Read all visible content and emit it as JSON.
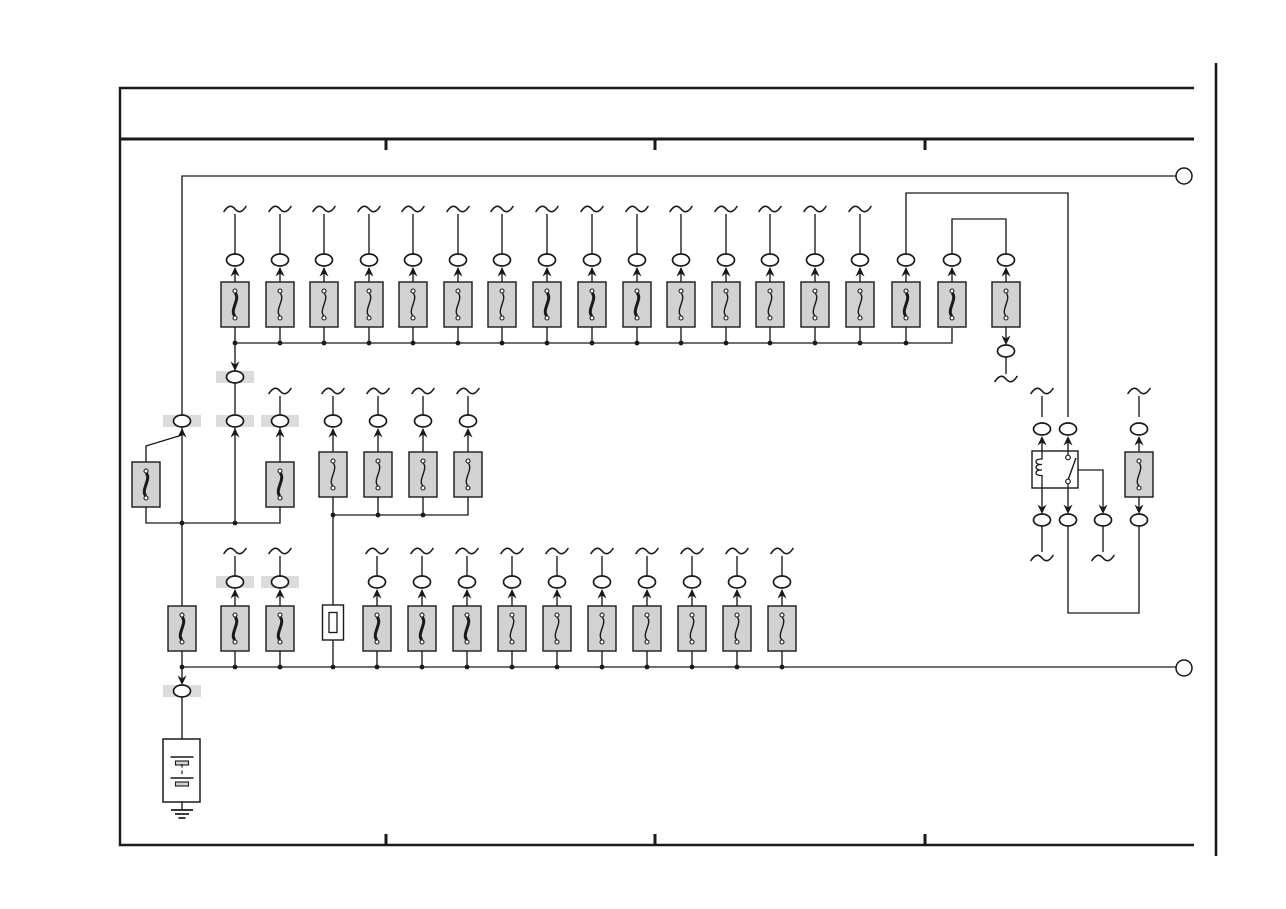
{
  "meta": {
    "page_type": "vehicle wiring schematic - power source / fuse block page",
    "width": 1286,
    "height": 909
  },
  "colors": {
    "line": "#1a1a1a",
    "fuse_fill": "#d2d2d2",
    "band_fill": "#dcdcdc",
    "component_fill": "#ffffff",
    "background": "#ffffff"
  },
  "style": {
    "wire_width": 1.35,
    "oval_rx": 8.5,
    "oval_ry": 6,
    "band_w": 38,
    "band_h": 12,
    "dot_r": 2.4,
    "ring_r": 8,
    "fuse_w": 28,
    "fuse_h": 45
  },
  "frame": {
    "border": {
      "left_x": 120,
      "top_y": 88,
      "right_x": 1194,
      "bottom_y": 845,
      "stroke_w": 2.4
    },
    "separator": {
      "y": 139,
      "x1": 120,
      "x2": 1194,
      "stroke_w": 3
    },
    "tick_xs": [
      386,
      655,
      925
    ],
    "tick_len": 10,
    "tick_stroke_w": 3,
    "page_edge": {
      "x": 1216,
      "y1": 63,
      "y2": 856,
      "stroke_w": 2.6
    }
  },
  "connector_rings": [
    [
      1184,
      176
    ],
    [
      1184,
      668
    ]
  ],
  "diagram": {
    "top_row": {
      "fuse_top_y": 282,
      "oval_cy": 260,
      "tilde_cy": 209,
      "bus_y": 343,
      "bus_dot_max_x": 950,
      "cols": [
        [
          235,
          1,
          1
        ],
        [
          280,
          0,
          1
        ],
        [
          324,
          0,
          1
        ],
        [
          369,
          0,
          1
        ],
        [
          413,
          0,
          1
        ],
        [
          458,
          0,
          1
        ],
        [
          502,
          0,
          1
        ],
        [
          547,
          1,
          1
        ],
        [
          592,
          1,
          1
        ],
        [
          637,
          1,
          1
        ],
        [
          681,
          0,
          1
        ],
        [
          726,
          0,
          1
        ],
        [
          770,
          0,
          1
        ],
        [
          815,
          0,
          1
        ],
        [
          860,
          0,
          1
        ],
        [
          906,
          1,
          0
        ],
        [
          952,
          1,
          0
        ],
        [
          1006,
          0,
          0
        ]
      ]
    },
    "mid_group": {
      "fuse_top_y": 452,
      "oval_cy": 421,
      "tilde_cy": 391,
      "bus_y": 515,
      "xs": [
        333,
        378,
        423,
        468
      ]
    },
    "bottom_row": {
      "fuse_top_y": 606,
      "oval_cy": 582,
      "tilde_cy": 551,
      "bus_y": 667,
      "cols": [
        [
          182,
          1,
          0
        ],
        [
          235,
          1,
          1
        ],
        [
          280,
          1,
          1
        ],
        [
          377,
          1,
          2
        ],
        [
          422,
          1,
          2
        ],
        [
          467,
          1,
          2
        ],
        [
          512,
          0,
          2
        ],
        [
          557,
          0,
          2
        ],
        [
          602,
          0,
          2
        ],
        [
          647,
          0,
          2
        ],
        [
          692,
          0,
          2
        ],
        [
          737,
          0,
          2
        ],
        [
          782,
          0,
          2
        ]
      ]
    },
    "extra_fuses": [
      [
        146,
        462,
        1
      ],
      [
        280,
        462,
        1
      ],
      [
        1139,
        452,
        0
      ]
    ],
    "extra_ovals": [
      [
        235,
        377,
        1
      ],
      [
        182,
        421,
        1
      ],
      [
        235,
        421,
        1
      ],
      [
        280,
        421,
        1
      ],
      [
        1006,
        351,
        0
      ],
      [
        1042,
        429,
        0
      ],
      [
        1068,
        429,
        0
      ],
      [
        1139,
        429,
        0
      ],
      [
        1042,
        520,
        0
      ],
      [
        1068,
        520,
        0
      ],
      [
        1103,
        520,
        0
      ],
      [
        1139,
        520,
        0
      ],
      [
        182,
        691,
        1
      ]
    ],
    "extra_arrows": [
      [
        235,
        371,
        -1
      ],
      [
        182,
        428,
        1
      ],
      [
        235,
        428,
        1
      ],
      [
        280,
        428,
        1
      ],
      [
        1006,
        345,
        -1
      ],
      [
        1042,
        436,
        1
      ],
      [
        1068,
        436,
        1
      ],
      [
        1139,
        436,
        1
      ],
      [
        1042,
        514,
        -1
      ],
      [
        1068,
        514,
        -1
      ],
      [
        1103,
        514,
        -1
      ],
      [
        1139,
        514,
        -1
      ],
      [
        182,
        685,
        -1
      ]
    ],
    "extra_tildes": [
      [
        280,
        391
      ],
      [
        1006,
        379
      ],
      [
        1042,
        391
      ],
      [
        1139,
        391
      ],
      [
        1042,
        558
      ],
      [
        1103,
        558
      ]
    ],
    "extra_dots": [
      [
        182,
        523
      ],
      [
        235,
        523
      ],
      [
        333,
        667
      ]
    ],
    "extra_wires": [
      [
        [
          182,
          606
        ],
        [
          182,
          176
        ],
        [
          1176,
          176
        ]
      ],
      [
        [
          235,
          370
        ],
        [
          235,
          343
        ],
        [
          952,
          343
        ],
        [
          952,
          328
        ]
      ],
      [
        [
          906,
          254
        ],
        [
          906,
          193
        ],
        [
          1068,
          193
        ],
        [
          1068,
          417
        ]
      ],
      [
        [
          952,
          254
        ],
        [
          952,
          219
        ],
        [
          1006,
          219
        ],
        [
          1006,
          254
        ]
      ],
      [
        [
          1006,
          327
        ],
        [
          1006,
          344
        ]
      ],
      [
        [
          1006,
          357
        ],
        [
          1006,
          374
        ]
      ],
      [
        [
          235,
          383
        ],
        [
          235,
          414
        ]
      ],
      [
        [
          235,
          428
        ],
        [
          235,
          523
        ]
      ],
      [
        [
          182,
          435
        ],
        [
          146,
          446
        ],
        [
          146,
          462
        ]
      ],
      [
        [
          146,
          507
        ],
        [
          146,
          523
        ],
        [
          280,
          523
        ],
        [
          280,
          507
        ]
      ],
      [
        [
          280,
          462
        ],
        [
          280,
          428
        ]
      ],
      [
        [
          280,
          414
        ],
        [
          280,
          396
        ]
      ],
      [
        [
          333,
          515
        ],
        [
          468,
          515
        ],
        [
          468,
          497
        ]
      ],
      [
        [
          333,
          515
        ],
        [
          333,
          605
        ]
      ],
      [
        [
          1042,
          396
        ],
        [
          1042,
          417
        ]
      ],
      [
        [
          1042,
          451
        ],
        [
          1042,
          438
        ]
      ],
      [
        [
          1042,
          488
        ],
        [
          1042,
          508
        ]
      ],
      [
        [
          1042,
          526
        ],
        [
          1042,
          552
        ]
      ],
      [
        [
          1068,
          451
        ],
        [
          1068,
          438
        ]
      ],
      [
        [
          1068,
          488
        ],
        [
          1068,
          508
        ]
      ],
      [
        [
          1068,
          526
        ],
        [
          1068,
          613
        ],
        [
          1139,
          613
        ],
        [
          1139,
          526
        ]
      ],
      [
        [
          1072,
          470
        ],
        [
          1103,
          470
        ],
        [
          1103,
          508
        ]
      ],
      [
        [
          1103,
          526
        ],
        [
          1103,
          552
        ]
      ],
      [
        [
          1139,
          396
        ],
        [
          1139,
          417
        ]
      ],
      [
        [
          1139,
          452
        ],
        [
          1139,
          438
        ]
      ],
      [
        [
          1139,
          497
        ],
        [
          1139,
          508
        ]
      ],
      [
        [
          333,
          640
        ],
        [
          333,
          667
        ]
      ],
      [
        [
          182,
          667
        ],
        [
          1176,
          667
        ]
      ],
      [
        [
          182,
          667
        ],
        [
          182,
          679
        ]
      ],
      [
        [
          182,
          697
        ],
        [
          182,
          739
        ]
      ],
      [
        [
          182,
          739
        ],
        [
          182,
          757
        ]
      ],
      [
        [
          182,
          785
        ],
        [
          182,
          810
        ]
      ]
    ],
    "fusible_link": {
      "x": 333,
      "top_y": 605,
      "w": 21,
      "h": 35,
      "inner_w": 8,
      "inner_h": 20
    },
    "relay": {
      "x": 1032,
      "y": 451,
      "w": 46,
      "h": 37,
      "coil_x": 1042,
      "switch_x": 1068,
      "contact_top_y": 457.5,
      "contact_bottom_y": 481.5,
      "contact_r": 2.3,
      "blade": [
        [
          1068,
          480
        ],
        [
          1076,
          458
        ]
      ]
    },
    "battery": {
      "box": [
        163,
        739,
        37,
        63
      ],
      "cx": 182,
      "cells": [
        {
          "long_y": 757,
          "bar_y": 761
        },
        {
          "long_y": 778,
          "bar_y": 782
        }
      ],
      "long_w": 23,
      "bar_w": 13,
      "bar_h": 4,
      "dash_y1": 764,
      "dash_y2": 776
    },
    "ground": {
      "x": 182,
      "top_y": 810,
      "widths": [
        22,
        14,
        7
      ],
      "gap": 4
    }
  }
}
